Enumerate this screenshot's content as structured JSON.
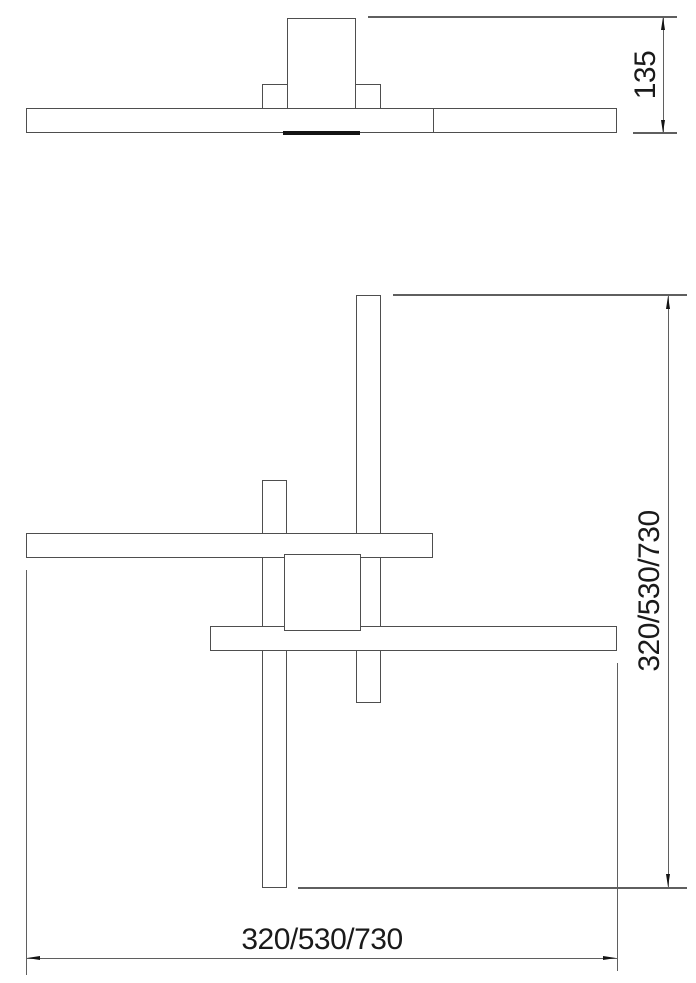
{
  "drawing": {
    "type": "technical-dimension-drawing",
    "side_view": {
      "height_dimension_label": "135"
    },
    "plan_view": {
      "vertical_dimension_label": "320/530/730",
      "horizontal_dimension_label": "320/530/730"
    },
    "colors": {
      "object_line": "#4e4e4e",
      "dimension_line": "#5f5f5f",
      "arrow_and_strip": "#141414",
      "text": "#1a1a1a",
      "background": "#ffffff"
    }
  }
}
